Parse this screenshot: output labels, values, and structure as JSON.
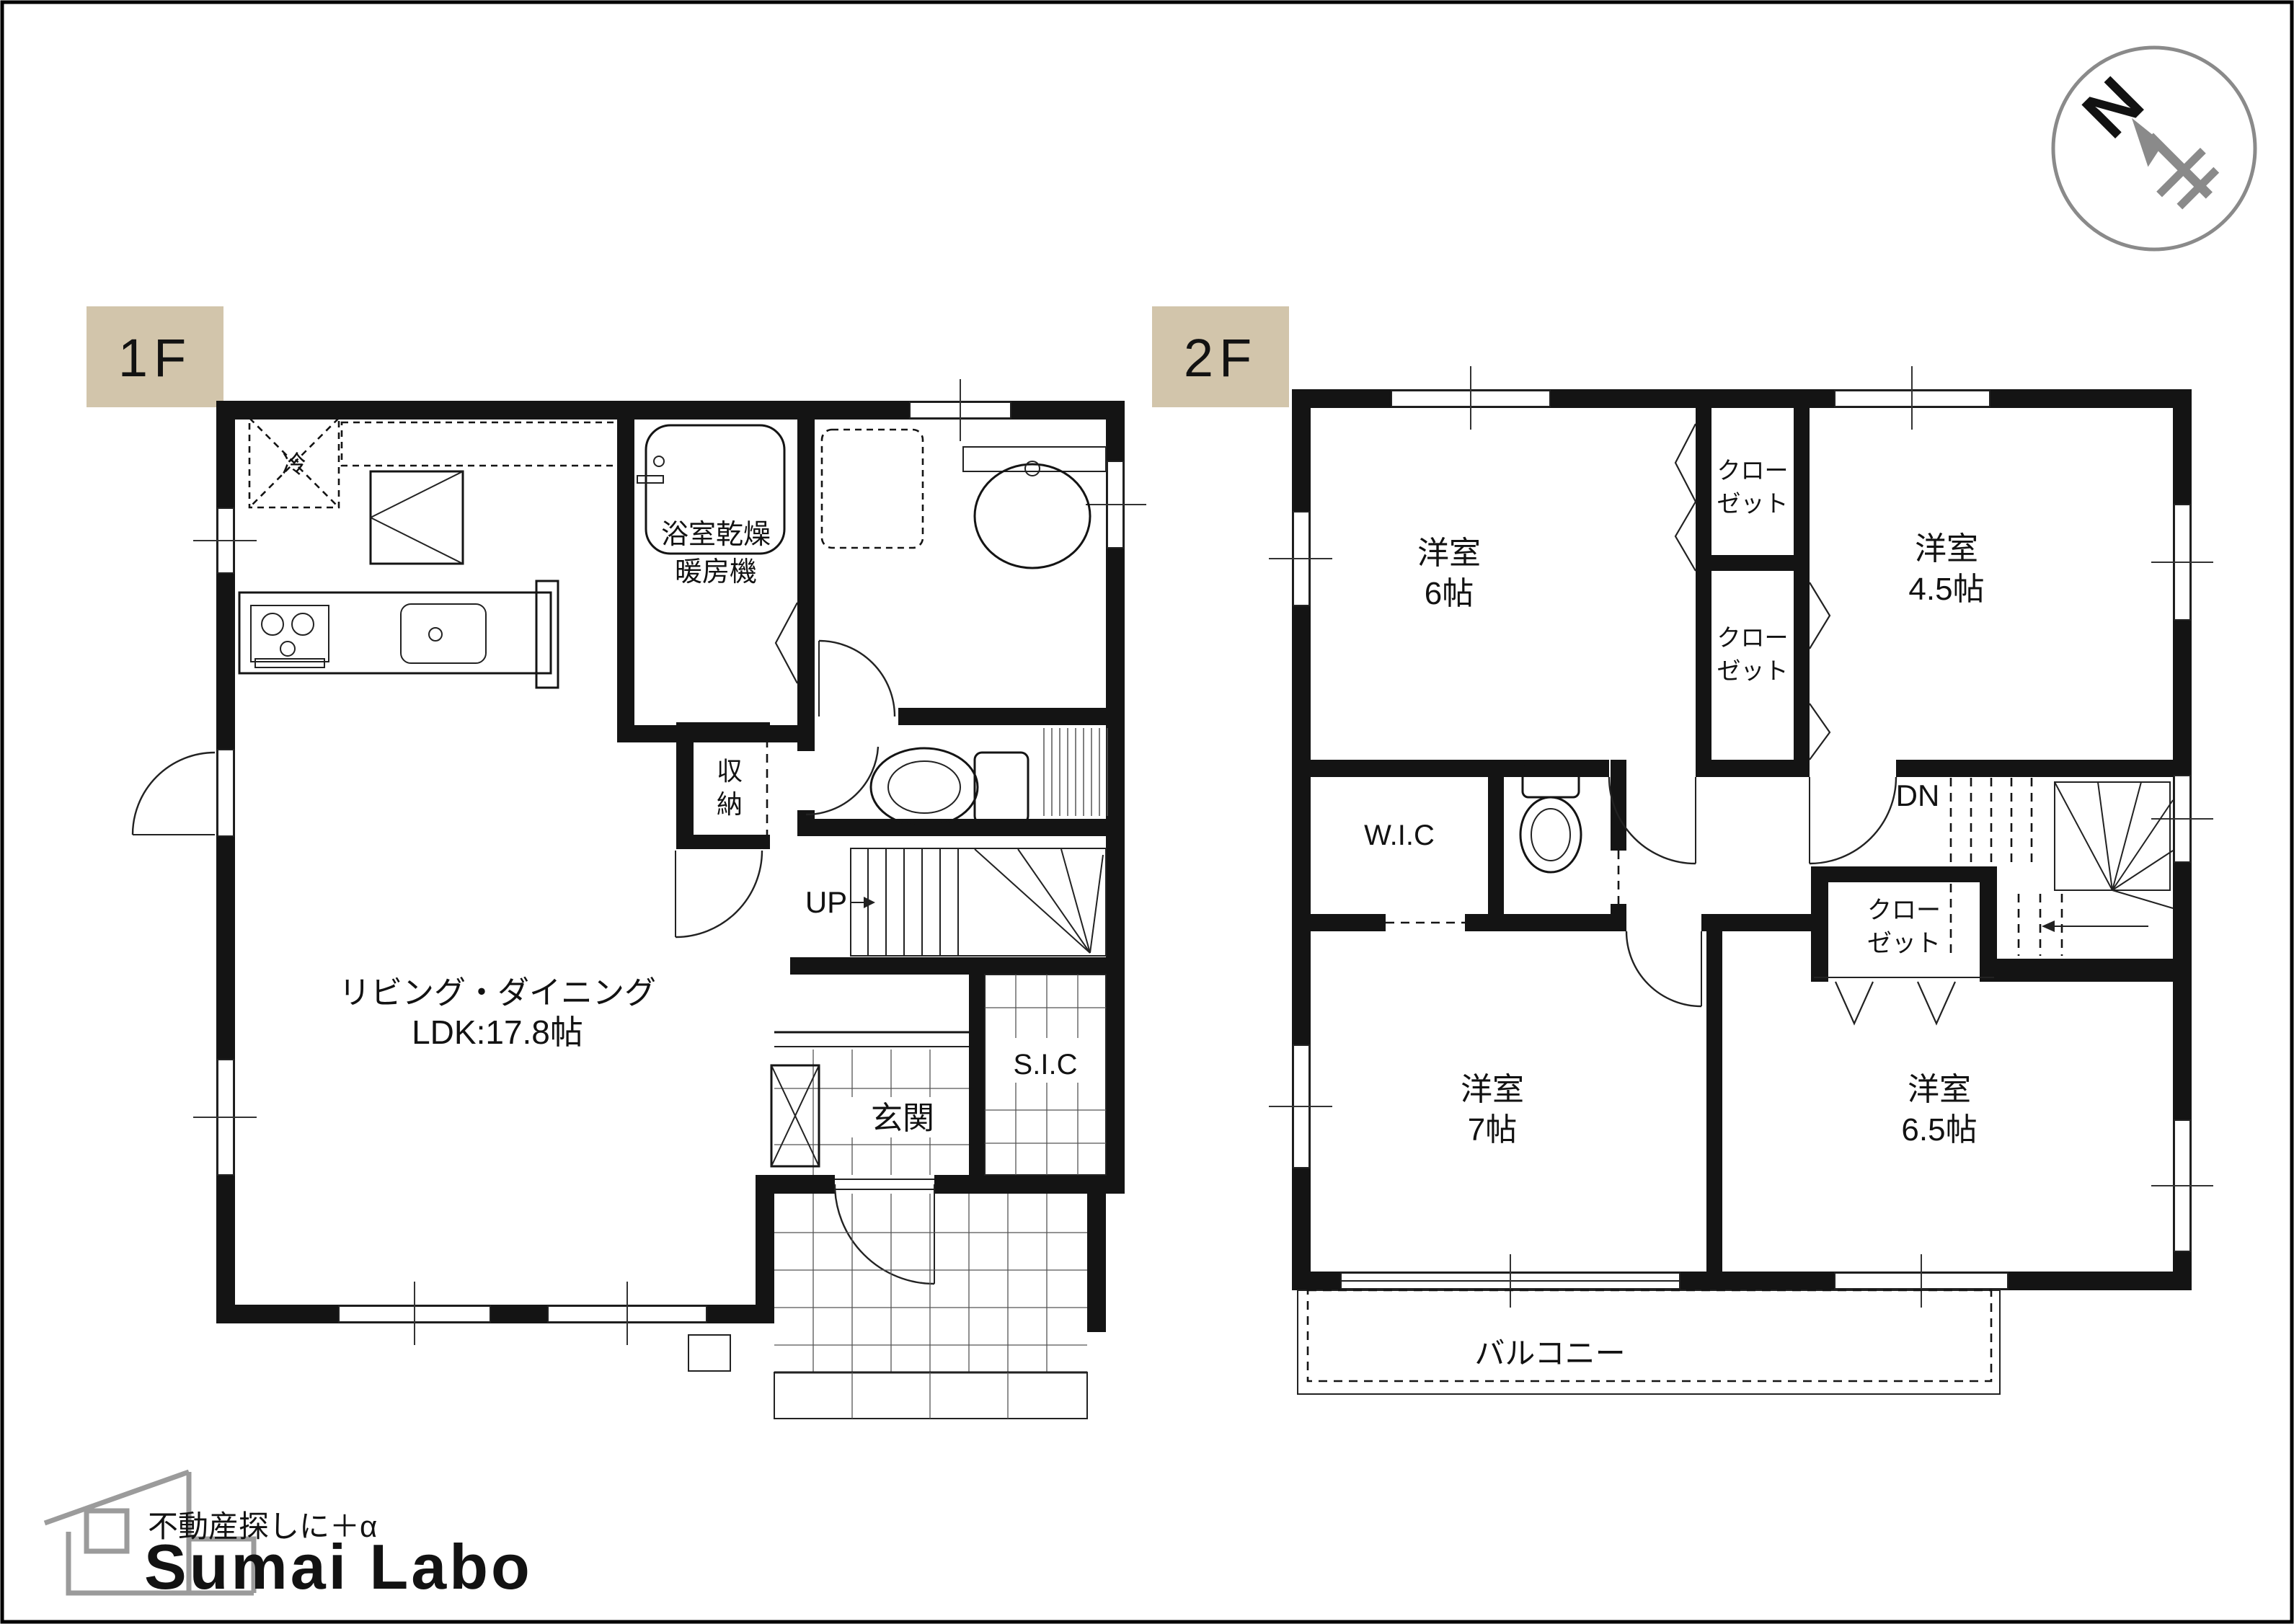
{
  "colors": {
    "tag_bg": "#d2c5ab",
    "tag_text": "#6e685c",
    "line": "#141414",
    "logo_gray": "#9b9b9b",
    "compass_gray": "#8a8a8a"
  },
  "compass": {
    "north": "N"
  },
  "floor1": {
    "tag": "1F",
    "labels": {
      "fridge": "冷",
      "bath_l1": "浴室乾燥",
      "bath_l2": "暖房機",
      "storage_l1": "収",
      "storage_l2": "納",
      "up": "UP",
      "ldk_l1": "リビング・ダイニング",
      "ldk_l2": "LDK:17.8帖",
      "sic": "S.I.C",
      "entrance": "玄関"
    }
  },
  "floor2": {
    "tag": "2F",
    "labels": {
      "bedroom6_l1": "洋室",
      "bedroom6_l2": "6帖",
      "bedroom45_l1": "洋室",
      "bedroom45_l2": "4.5帖",
      "bedroom7_l1": "洋室",
      "bedroom7_l2": "7帖",
      "bedroom65_l1": "洋室",
      "bedroom65_l2": "6.5帖",
      "closet_top_l1": "クロー",
      "closet_top_l2": "ゼット",
      "closet_mid_l1": "クロー",
      "closet_mid_l2": "ゼット",
      "closet_low_l1": "クロー",
      "closet_low_l2": "ゼット",
      "wic": "W.I.C",
      "dn": "DN",
      "balcony": "バルコニー"
    }
  },
  "footer": {
    "tagline": "不動産探しに＋α",
    "brand": "Sumai Labo"
  }
}
